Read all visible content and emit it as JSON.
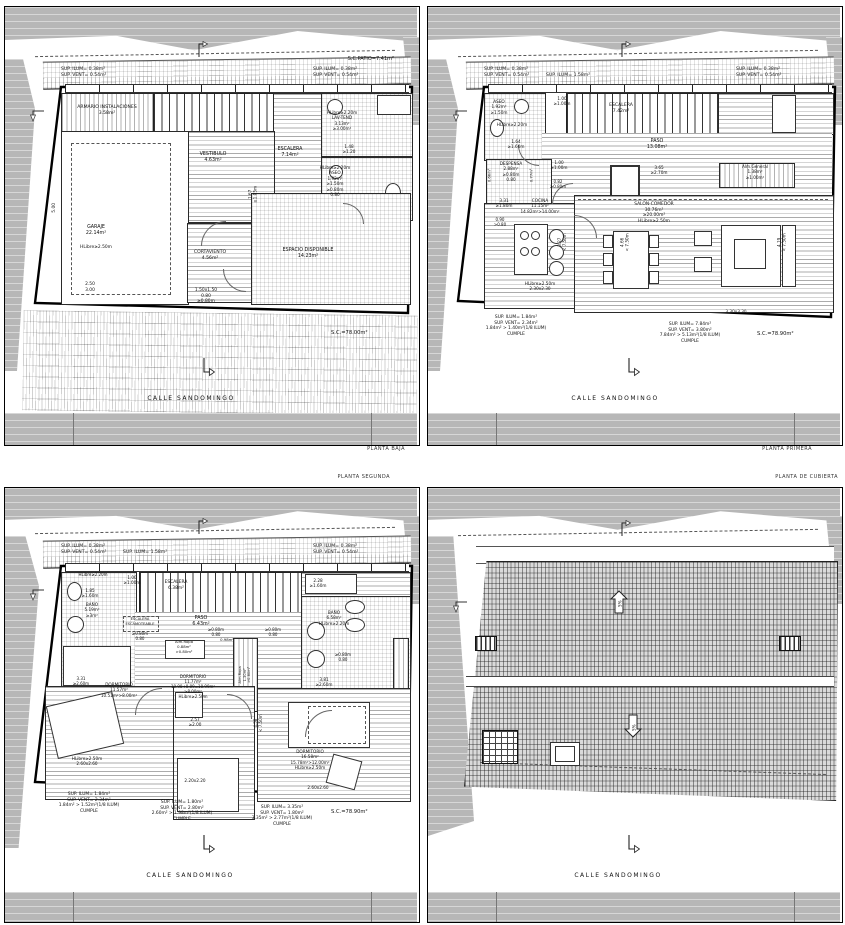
{
  "document_titles": {
    "baja": "PLANTA BAJA",
    "primera": "PLANTA PRIMERA",
    "segunda": "PLANTA SEGUNDA",
    "cubierta": "PLANTA DE CUBIERTA"
  },
  "street_name": "CALLE  SANDOMINGO",
  "colors": {
    "neighbor_mass": "#b7b7b7",
    "linework": "#111111",
    "paper": "#ffffff",
    "roof_tiles": "#dadada"
  },
  "icons": {
    "street_arrow": "north/street direction arrow",
    "boundary_arrow": "property boundary arrow",
    "hook_arrow": "side reference arrow",
    "slope_up_arrow": "roof slope up 5%",
    "slope_down_arrow": "roof slope down 5%"
  },
  "plans": {
    "baja": {
      "labels": [
        {
          "n": "patio-area-label",
          "t": "S.C.PATIO=7.41m²",
          "x": 389,
          "y": 49,
          "ta": "r",
          "fs": 5
        },
        {
          "n": "sup-ilum-vent-left",
          "t": "SUP. ILUM=  0.38m²\nSUP. VENT=  0.54m²",
          "x": 56,
          "y": 60,
          "ta": "l",
          "fs": 4.6
        },
        {
          "n": "sup-ilum-vent-right",
          "t": "SUP. ILUM=  0.38m²\nSUP. VENT=  0.54m²",
          "x": 308,
          "y": 60,
          "ta": "l",
          "fs": 4.6
        },
        {
          "n": "room-label-armario",
          "t": "ARMARIO  INSTALACIONES\n3.58m²",
          "x": 102,
          "y": 98,
          "fs": 4.6
        },
        {
          "n": "room-label-garaje",
          "t": "GARAJE\n22.14m²",
          "x": 91,
          "y": 218
        },
        {
          "n": "garaje-hlibre",
          "t": "HLibre≥2.50m",
          "x": 91,
          "y": 238,
          "fs": 4.4
        },
        {
          "n": "garaje-dims",
          "t": "2.50\n3.00",
          "x": 85,
          "y": 275,
          "fs": 4.4
        },
        {
          "n": "dim-left-500",
          "t": "5.00",
          "x": 50,
          "y": 198,
          "r": -90,
          "fs": 4.4
        },
        {
          "n": "room-label-vestibulo",
          "t": "VESTIBULO\n4.63m²",
          "x": 208,
          "y": 145
        },
        {
          "n": "room-label-escalera",
          "t": "ESCALERA\n7.14m²",
          "x": 285,
          "y": 140
        },
        {
          "n": "vestibulo-dim",
          "t": "1.67\n≥1.05m",
          "x": 248,
          "y": 182,
          "r": -90,
          "fs": 4.2
        },
        {
          "n": "room-label-lavtend",
          "t": "HLibre≥2.20m\nLAV-TEND\n3.13m²\n≥3.00m²",
          "x": 337,
          "y": 103,
          "fs": 4.2
        },
        {
          "n": "lavtend-dim",
          "t": "1.48\n≥1.20",
          "x": 344,
          "y": 137,
          "fs": 4.2
        },
        {
          "n": "room-label-aseo",
          "t": "HLibre≥2.20m\nASEO\n1.92m²\n≥1.50m\n≥0.80m\n0.80",
          "x": 330,
          "y": 158,
          "fs": 4.2
        },
        {
          "n": "room-label-cortaviento",
          "t": "CORTAVIENTO\n4.56m²",
          "x": 205,
          "y": 243,
          "fs": 4.6
        },
        {
          "n": "cortaviento-dims",
          "t": "1.50x1.50\n0.80\n≥0.80m",
          "x": 201,
          "y": 281,
          "fs": 4.4
        },
        {
          "n": "room-label-espacio",
          "t": "ESPACIO  DISPONIBLE\n14.23m²",
          "x": 303,
          "y": 241
        },
        {
          "n": "plot-area-label",
          "t": "S.C.=78.00m²",
          "x": 326,
          "y": 323,
          "ta": "l",
          "fs": 5.2
        },
        {
          "n": "street-name",
          "t": "CALLE  SANDOMINGO",
          "x": 186,
          "y": 388,
          "fs": 6,
          "ls": 1.5
        }
      ]
    },
    "primera": {
      "labels": [
        {
          "n": "sup-ilum-vent-left",
          "t": "SUP. ILUM=  0.38m²\nSUP. VENT=  0.54m²",
          "x": 56,
          "y": 60,
          "ta": "l",
          "fs": 4.6
        },
        {
          "n": "sup-ilum-mid",
          "t": "SUP. ILUM= 1.58m²",
          "x": 118,
          "y": 66,
          "ta": "l",
          "fs": 4.6
        },
        {
          "n": "sup-ilum-vent-right",
          "t": "SUP. ILUM=  0.38m²\nSUP. VENT=  0.54m²",
          "x": 308,
          "y": 60,
          "ta": "l",
          "fs": 4.6
        },
        {
          "n": "room-label-aseo",
          "t": "ASEO\n1.92m²\n≥1.50m",
          "x": 71,
          "y": 92,
          "fs": 4.2
        },
        {
          "n": "aseo-hlibre",
          "t": "HLibre≥2.20m",
          "x": 84,
          "y": 115,
          "fs": 4.2
        },
        {
          "n": "room-label-escalera",
          "t": "ESCALERA\n7.42m²",
          "x": 193,
          "y": 96,
          "fs": 4.6
        },
        {
          "n": "dim-100-top",
          "t": "1.00\n≥1.00m",
          "x": 134,
          "y": 89,
          "fs": 4.2
        },
        {
          "n": "room-label-paso",
          "t": "PASO\n13.08m²",
          "x": 229,
          "y": 132
        },
        {
          "n": "dim-164",
          "t": "1.64\n≥1.60m",
          "x": 88,
          "y": 132,
          "fs": 4.2
        },
        {
          "n": "room-label-despensa",
          "t": "DESPENSA\n2.88m²\n≥0.80m\n0.80",
          "x": 83,
          "y": 154,
          "fs": 4.2
        },
        {
          "n": "despensa-dim-left",
          "t": "0.66m²",
          "x": 62,
          "y": 166,
          "r": -90,
          "fs": 3.8
        },
        {
          "n": "despensa-dim-right",
          "t": "0.77m²",
          "x": 104,
          "y": 166,
          "r": -90,
          "fs": 3.8
        },
        {
          "n": "dim-100-mid",
          "t": "1.00\n≥1.00m",
          "x": 131,
          "y": 153,
          "fs": 4.2
        },
        {
          "n": "dim-082",
          "t": "0.82\n≥0.80m",
          "x": 130,
          "y": 172,
          "fs": 4
        },
        {
          "n": "dim-365",
          "t": "3.65\n≥2.70m",
          "x": 231,
          "y": 158,
          "fs": 4.2
        },
        {
          "n": "room-label-almgeneral",
          "t": "Alm.General\n1.38m²\n≥1.00m²",
          "x": 327,
          "y": 157,
          "fs": 4.2
        },
        {
          "n": "dim-331",
          "t": "3.31\n≥1.80m",
          "x": 76,
          "y": 191,
          "fs": 4.2
        },
        {
          "n": "room-label-cocina",
          "t": "COCINA\n11.15m²\n14.82m²>14.00m²",
          "x": 112,
          "y": 191,
          "fs": 4.2
        },
        {
          "n": "dim-090",
          "t": "0.90\n>0.80",
          "x": 72,
          "y": 210,
          "fs": 4
        },
        {
          "n": "room-label-salon",
          "t": "SALON-COMEDOR\n30.76m²\n≥20.00m²\nHLibre≥2.50m",
          "x": 226,
          "y": 195,
          "fs": 4.4
        },
        {
          "n": "cocina-hlibre",
          "t": "HLibre≥2.50m\n2.30x2.30",
          "x": 112,
          "y": 274,
          "fs": 4.2
        },
        {
          "n": "dim-330x330",
          "t": "3.30x3.30",
          "x": 308,
          "y": 302,
          "fs": 4.2
        },
        {
          "n": "dim-466",
          "t": "4.66\n< 7.50m",
          "x": 197,
          "y": 230,
          "r": -90,
          "fs": 4.2
        },
        {
          "n": "dim-327",
          "t": "3.27\n< 7.50m",
          "x": 134,
          "y": 230,
          "r": -90,
          "fs": 4
        },
        {
          "n": "dim-419",
          "t": "4.19\n< 7.50m",
          "x": 354,
          "y": 230,
          "r": -90,
          "fs": 4.2
        },
        {
          "n": "compliance-left",
          "t": "SUP. ILUM=      1.84m²\nSUP. VENT=      2.34m²\n1.84m²  >  1.40m²(1/8 ILUM)\nCUMPLE",
          "x": 88,
          "y": 308,
          "fs": 4.4
        },
        {
          "n": "compliance-right",
          "t": "SUP. ILUM=      7.84m²\nSUP. VENT=      3.80m²\n7.84m²  >  5.13m²(1/8 ILUM)\nCUMPLE",
          "x": 262,
          "y": 315,
          "fs": 4.4
        },
        {
          "n": "plot-area-label",
          "t": "S.C.=78.90m²",
          "x": 329,
          "y": 324,
          "ta": "l",
          "fs": 5.2
        },
        {
          "n": "street-name",
          "t": "CALLE  SANDOMINGO",
          "x": 187,
          "y": 388,
          "fs": 6,
          "ls": 1.5
        }
      ]
    },
    "segunda": {
      "labels": [
        {
          "n": "sup-ilum-vent-left",
          "t": "SUP. ILUM=  0.38m²\nSUP. VENT=  0.54m²",
          "x": 56,
          "y": 56,
          "ta": "l",
          "fs": 4.6
        },
        {
          "n": "sup-ilum-mid",
          "t": "SUP. ILUM= 1.58m²",
          "x": 118,
          "y": 62,
          "ta": "l",
          "fs": 4.6
        },
        {
          "n": "sup-ilum-vent-right",
          "t": "SUP. ILUM=  0.38m²\nSUP. VENT=  0.54m²",
          "x": 308,
          "y": 56,
          "ta": "l",
          "fs": 4.6
        },
        {
          "n": "bath-left-hlibre",
          "t": "HLibre≥2.20m",
          "x": 88,
          "y": 84,
          "fs": 4
        },
        {
          "n": "bath-left-dim",
          "t": "1.85\n≥1.60m",
          "x": 85,
          "y": 100,
          "fs": 4.2
        },
        {
          "n": "room-label-bath-left",
          "t": "BAÑO\n5.19m²\n≥3m²",
          "x": 87,
          "y": 114,
          "fs": 4.2
        },
        {
          "n": "room-label-escalera",
          "t": "ESCALERA\n6.38m²",
          "x": 171,
          "y": 92,
          "fs": 4.4
        },
        {
          "n": "dim-100",
          "t": "1.00\n≥1.00m",
          "x": 127,
          "y": 87,
          "fs": 4.2
        },
        {
          "n": "dim-228",
          "t": "2.28\n≥1.60m",
          "x": 313,
          "y": 90,
          "fs": 4.2
        },
        {
          "n": "room-label-paso",
          "t": "PASO\n6.43m²",
          "x": 196,
          "y": 128
        },
        {
          "n": "esc-escamoteable-label",
          "t": "ESCALERA\nESCAMOTEABLE",
          "x": 135,
          "y": 129,
          "fs": 3.6
        },
        {
          "n": "esc-escamoteable-dim",
          "t": "≥0.80m\n0.80",
          "x": 135,
          "y": 143,
          "fs": 4
        },
        {
          "n": "alm-ropa-1-label",
          "t": "Alm.Ropa\n0.88m²\n>0.80m²",
          "x": 179,
          "y": 152,
          "fs": 3.8
        },
        {
          "n": "dim-080-a",
          "t": "≥0.80m\n0.80",
          "x": 211,
          "y": 139,
          "fs": 4
        },
        {
          "n": "dim-098",
          "t": "0.98m²",
          "x": 222,
          "y": 150,
          "fs": 3.8
        },
        {
          "n": "dim-080-b",
          "t": "≥0.80m\n0.80",
          "x": 268,
          "y": 139,
          "fs": 4
        },
        {
          "n": "alm-ropa-2-label",
          "t": "Alm.Ropa\n1.30m²\n>0.80m²",
          "x": 240,
          "y": 180,
          "r": -90,
          "fs": 3.6
        },
        {
          "n": "room-label-bath-right",
          "t": "BAÑO\n6.58m²\nHLibre≥2.20m",
          "x": 329,
          "y": 122,
          "fs": 4.2
        },
        {
          "n": "bath-right-dim",
          "t": "≥0.80m\n0.80",
          "x": 338,
          "y": 164,
          "fs": 4
        },
        {
          "n": "dim-381",
          "t": "3.81\n≥2.60m",
          "x": 319,
          "y": 189,
          "fs": 4.2
        },
        {
          "n": "dim-331",
          "t": "3.31\n≥2.60m",
          "x": 76,
          "y": 188,
          "fs": 4
        },
        {
          "n": "room-label-dorm1",
          "t": "DORMITORIO\n11.57m²\n10.51m²>8.00m²",
          "x": 114,
          "y": 194,
          "fs": 4.2
        },
        {
          "n": "dorm1-hlibre",
          "t": "HLibre≥2.50m\n2.60x2.60",
          "x": 82,
          "y": 268,
          "fs": 4.2
        },
        {
          "n": "room-label-dorm2",
          "t": "DORMITORIO\n11.77m²\n10.90+0.09=10.99m²\n>8.00m²\nHLibre≥2.50m",
          "x": 188,
          "y": 186,
          "fs": 4
        },
        {
          "n": "dorm2-dim",
          "t": "2.57\n≥2.00",
          "x": 190,
          "y": 229,
          "fs": 4.2
        },
        {
          "n": "dim-458",
          "t": "4.58\n< 7.50m",
          "x": 253,
          "y": 230,
          "r": -90,
          "fs": 4
        },
        {
          "n": "dorm2-dim2",
          "t": "2.20x2.20",
          "x": 190,
          "y": 290,
          "fs": 4.2
        },
        {
          "n": "room-label-dorm3",
          "t": "DORMITORIO\n16.58m²\n15.78m²>12.00m²\nHLibre≥2.50m",
          "x": 305,
          "y": 261,
          "fs": 4.2
        },
        {
          "n": "dorm3-dim",
          "t": "2.60x2.60",
          "x": 313,
          "y": 297,
          "fs": 4.2
        },
        {
          "n": "compliance-1",
          "t": "SUP. ILUM=      1.84m²\nSUP. VENT=      2.34m²\n1.84m²  >  1.52m²(1/8 ILUM)\nCUMPLE",
          "x": 84,
          "y": 304,
          "fs": 4.4
        },
        {
          "n": "compliance-2",
          "t": "SUP. ILUM=      1.80m²\nSUP. VENT=      2.80m²\n2.60m²  >  1.98m²(1/8 ILUM)\nCUMPLE",
          "x": 177,
          "y": 312,
          "fs": 4.4
        },
        {
          "n": "compliance-3",
          "t": "SUP. ILUM=      3.35m²\nSUP. VENT=      1.80m²\n3.35m²  >  2.77m²(1/8 ILUM)\nCUMPLE",
          "x": 277,
          "y": 317,
          "fs": 4.4
        },
        {
          "n": "plot-area-label",
          "t": "S.C.=78.90m²",
          "x": 326,
          "y": 321,
          "ta": "l",
          "fs": 5.2
        },
        {
          "n": "street-name",
          "t": "CALLE  SANDOMINGO",
          "x": 185,
          "y": 384,
          "fs": 6,
          "ls": 1.5
        }
      ]
    },
    "cubierta": {
      "labels": [
        {
          "n": "slope-up-label",
          "t": "5%",
          "x": 192,
          "y": 113,
          "r": -90,
          "fs": 4.2
        },
        {
          "n": "slope-down-label",
          "t": "5%",
          "x": 206,
          "y": 237,
          "r": -90,
          "fs": 4.2
        },
        {
          "n": "street-name",
          "t": "CALLE  SANDOMINGO",
          "x": 190,
          "y": 384,
          "fs": 6,
          "ls": 1.5
        }
      ]
    }
  }
}
